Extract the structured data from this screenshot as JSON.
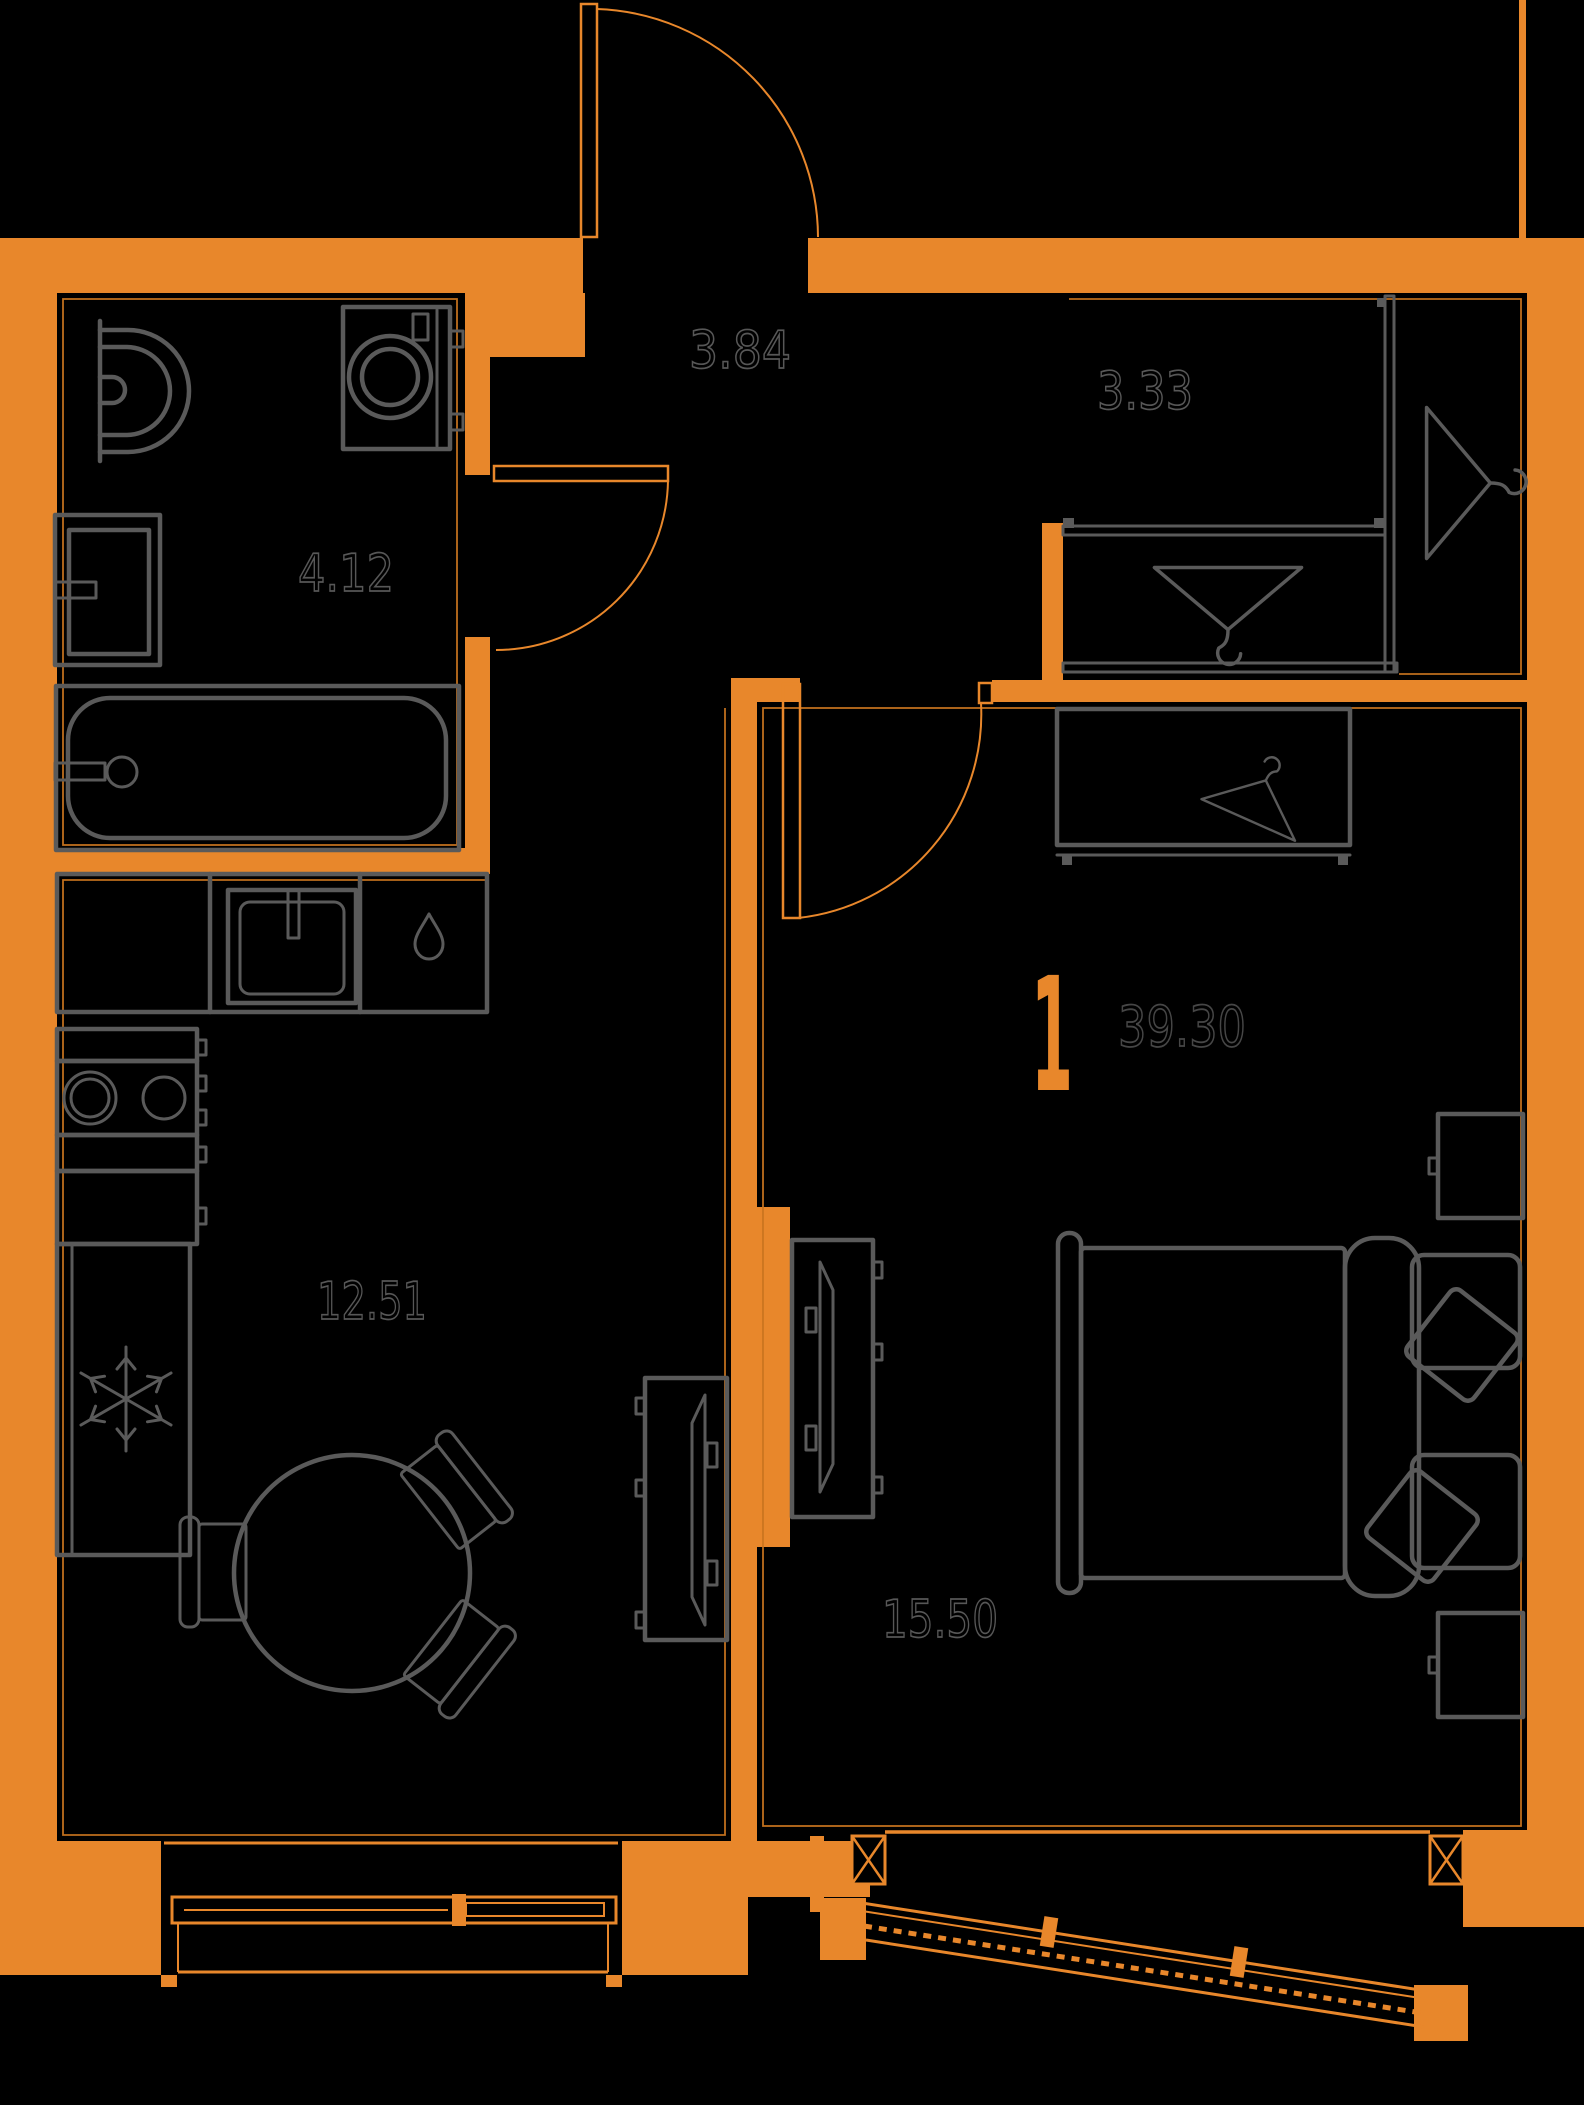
{
  "plan": {
    "type": "apartment-floor-plan",
    "unit_rooms_count": "1",
    "total_area": "39.30",
    "rooms": [
      {
        "name": "hallway",
        "area": "3.84"
      },
      {
        "name": "wardrobe",
        "area": "3.33"
      },
      {
        "name": "bathroom",
        "area": "4.12"
      },
      {
        "name": "kitchen-living",
        "area": "12.51"
      },
      {
        "name": "bedroom",
        "area": "15.50"
      }
    ],
    "colors": {
      "background": "#000000",
      "walls": "#E8872B",
      "furniture": "#5A5A5A",
      "inset": "#C8741F",
      "labels": "#575757",
      "total": "#464646"
    },
    "icons": {
      "hanger": "hanger-icon",
      "snowflake": "snowflake-icon",
      "water_drop": "water-drop-icon"
    }
  }
}
